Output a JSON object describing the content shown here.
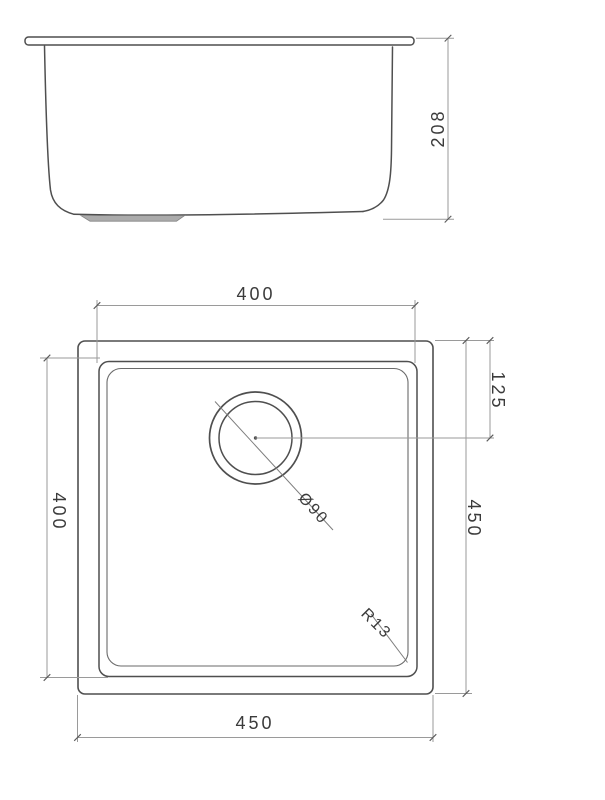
{
  "drawing": {
    "type": "sink technical drawing",
    "background_color": "#ffffff",
    "object_line_color": "#4f4f4f",
    "dimension_line_color": "#9a9a9a",
    "text_color": "#3b3b3b",
    "side_view": {
      "depth_label": "208",
      "depth_value": 208
    },
    "plan_view": {
      "bowl_width_label": "400",
      "bowl_width_value": 400,
      "bowl_height_label": "400",
      "bowl_height_value": 400,
      "overall_width_label": "450",
      "overall_width_value": 450,
      "overall_height_label": "450",
      "overall_height_value": 450,
      "drain_offset_label": "125",
      "drain_offset_value": 125,
      "drain_diameter_label": "Ø90",
      "drain_diameter_value": 90,
      "corner_radius_label": "R13",
      "corner_radius_value": 13
    }
  }
}
